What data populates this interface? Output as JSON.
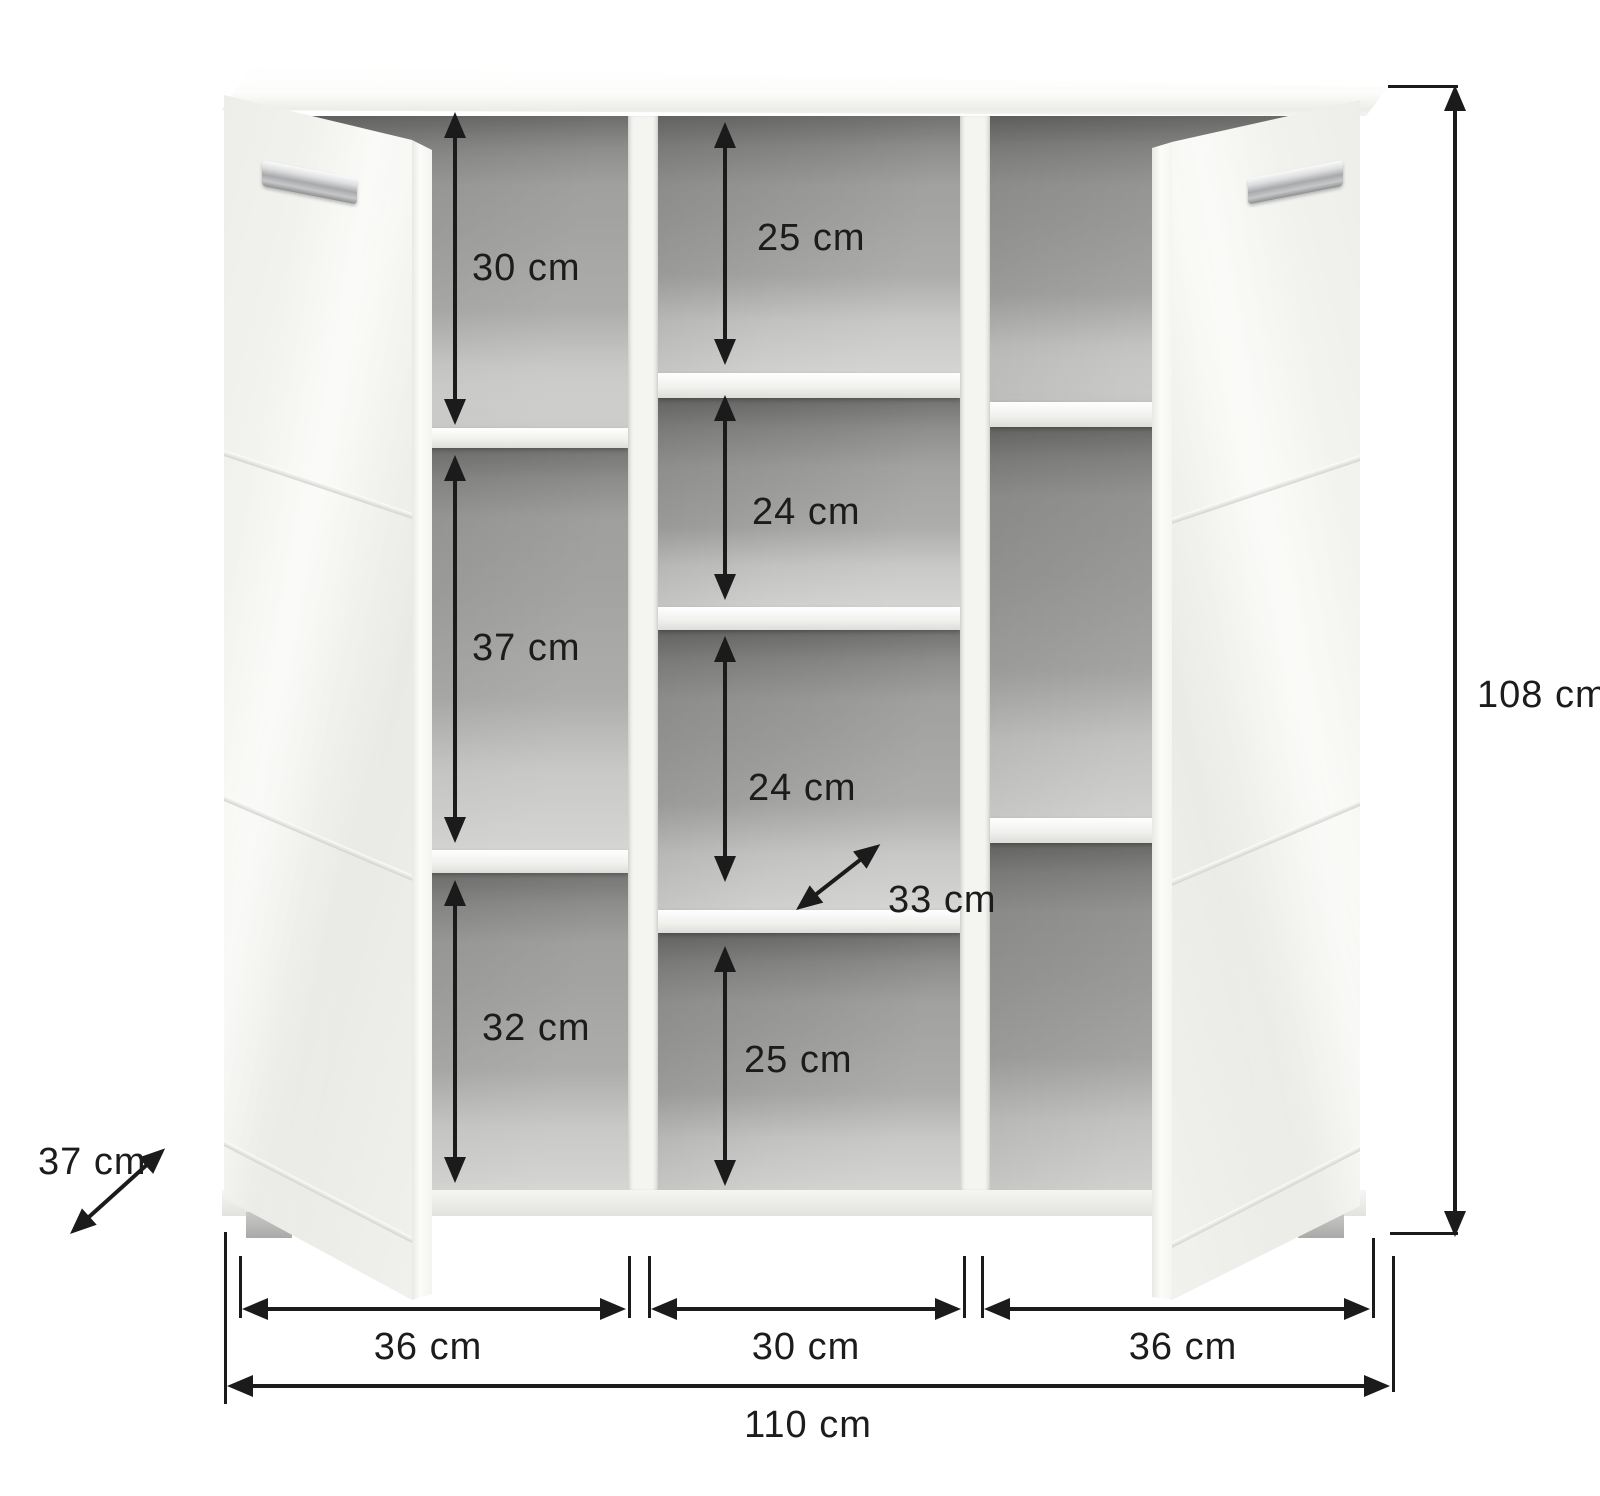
{
  "colors": {
    "background": "#ffffff",
    "annotation": "#1b1b1b",
    "cabinet": "#f4f4f1",
    "interior": "#9a9a98"
  },
  "annotations": {
    "left_column_heights": [
      "30 cm",
      "37 cm",
      "32 cm"
    ],
    "middle_column_heights": [
      "25 cm",
      "24 cm",
      "24 cm",
      "25 cm"
    ],
    "shelf_depth": "33 cm",
    "cabinet_depth": "37 cm",
    "cabinet_height": "108 cm",
    "bottom_section_widths": [
      "36 cm",
      "30 cm",
      "36 cm"
    ],
    "total_width": "110 cm"
  }
}
